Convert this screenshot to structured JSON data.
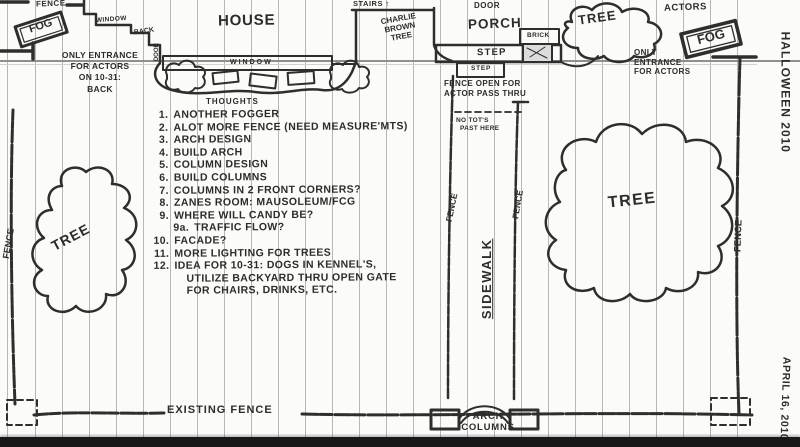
{
  "colors": {
    "ink": "#2c2c2c",
    "paper": "#fbfbf8",
    "ruling": "#b7b7b7",
    "margin_line": "#8f8f8f",
    "scan_bar": "#181818"
  },
  "margin": {
    "top_note": "HALLOWEEN 2010",
    "bottom_note": "APRIL 16, 2010"
  },
  "house": {
    "label": "HOUSE",
    "window_step": "WINDOW",
    "back": "BACK",
    "back_door": "DOOR",
    "front_window": "WINDOW",
    "stairs": "STAIRS ↑",
    "charlie": [
      "CHARLIE",
      "BROWN",
      "TREE"
    ]
  },
  "porch": {
    "door": "DOOR",
    "label": "PORCH",
    "step_upper": "STEP",
    "step_lower": "STEP",
    "brick": "BRICK"
  },
  "fences": {
    "top_left": "FENCE",
    "left": "FENCE",
    "right": "FENCE",
    "sidewalk_left": "FENCE",
    "sidewalk_right": "FENCE",
    "existing": "EXISTING FENCE",
    "open_note": [
      "FENCE OPEN FOR",
      "ACTOR PASS THRU"
    ],
    "no_tots": [
      "NO TOT'S",
      "PAST HERE"
    ]
  },
  "fog": {
    "left": "FOG",
    "right": "FOG"
  },
  "actors": {
    "label": "ACTORS",
    "left_entrance": [
      "ONLY ENTRANCE",
      "FOR ACTORS",
      "ON 10-31:",
      "BACK"
    ],
    "right_entrance": [
      "ONLY",
      "ENTRANCE",
      "FOR ACTORS"
    ]
  },
  "trees": {
    "left": "TREE",
    "right": "TREE",
    "top_right": "TREE"
  },
  "sidewalk": {
    "label": "SIDEWALK",
    "arch": [
      "ARCH",
      "COLUMNS"
    ]
  },
  "thoughts": {
    "title": "THOUGHTS",
    "items": [
      {
        "num": "1.",
        "text": "ANOTHER FOGGER"
      },
      {
        "num": "2.",
        "text": "ALOT MORE FENCE (NEED MEASURE'MTS)"
      },
      {
        "num": "3.",
        "text": "ARCH DESIGN"
      },
      {
        "num": "4.",
        "text": "BUILD ARCH"
      },
      {
        "num": "5.",
        "text": "COLUMN DESIGN"
      },
      {
        "num": "6.",
        "text": "BUILD COLUMNS"
      },
      {
        "num": "7.",
        "text": "COLUMNS IN 2 FRONT CORNERS?"
      },
      {
        "num": "8.",
        "text": "ZANES ROOM: MAUSOLEUM/FCG"
      },
      {
        "num": "9.",
        "text": "WHERE WILL CANDY BE?"
      },
      {
        "num": "9a.",
        "text": "TRAFFIC FLOW?"
      },
      {
        "num": "10.",
        "text": "FACADE?"
      },
      {
        "num": "11.",
        "text": "MORE LIGHTING FOR TREES"
      },
      {
        "num": "12.",
        "text": "IDEA FOR 10-31: DOGS IN KENNEL'S,"
      },
      {
        "num": "",
        "text": "UTILIZE BACKYARD THRU OPEN GATE"
      },
      {
        "num": "",
        "text": "FOR CHAIRS, DRINKS, ETC."
      }
    ]
  }
}
